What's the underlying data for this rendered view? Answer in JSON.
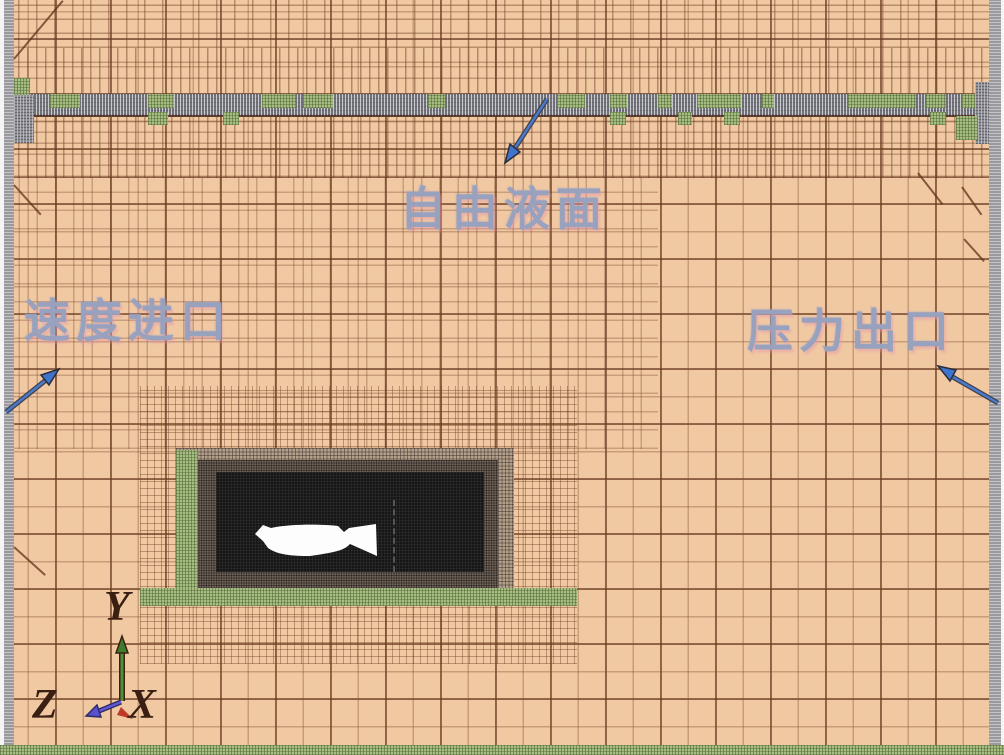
{
  "figure": {
    "annotations": {
      "free_surface": "自由液面",
      "velocity_inlet": "速度进口",
      "pressure_outlet": "压力出口"
    },
    "axis_triad": {
      "x_label": "X",
      "y_label": "Y",
      "z_label": "Z"
    },
    "colors": {
      "mesh_background": "#f0c9a3",
      "mesh_line_brown": "#7a4526",
      "free_surface_band_gray": "#97979d",
      "refinement_green": "#a7bd84",
      "annotation_text_blue": "#98a1bd",
      "annotation_arrow_blue": "#3f74cc",
      "axis_x_red": "#c03a2a",
      "axis_y_green": "#3f7d2e",
      "axis_z_violet": "#5b50cf",
      "hull_block_black": "#161616",
      "vessel_white": "#fdfdfd"
    }
  }
}
